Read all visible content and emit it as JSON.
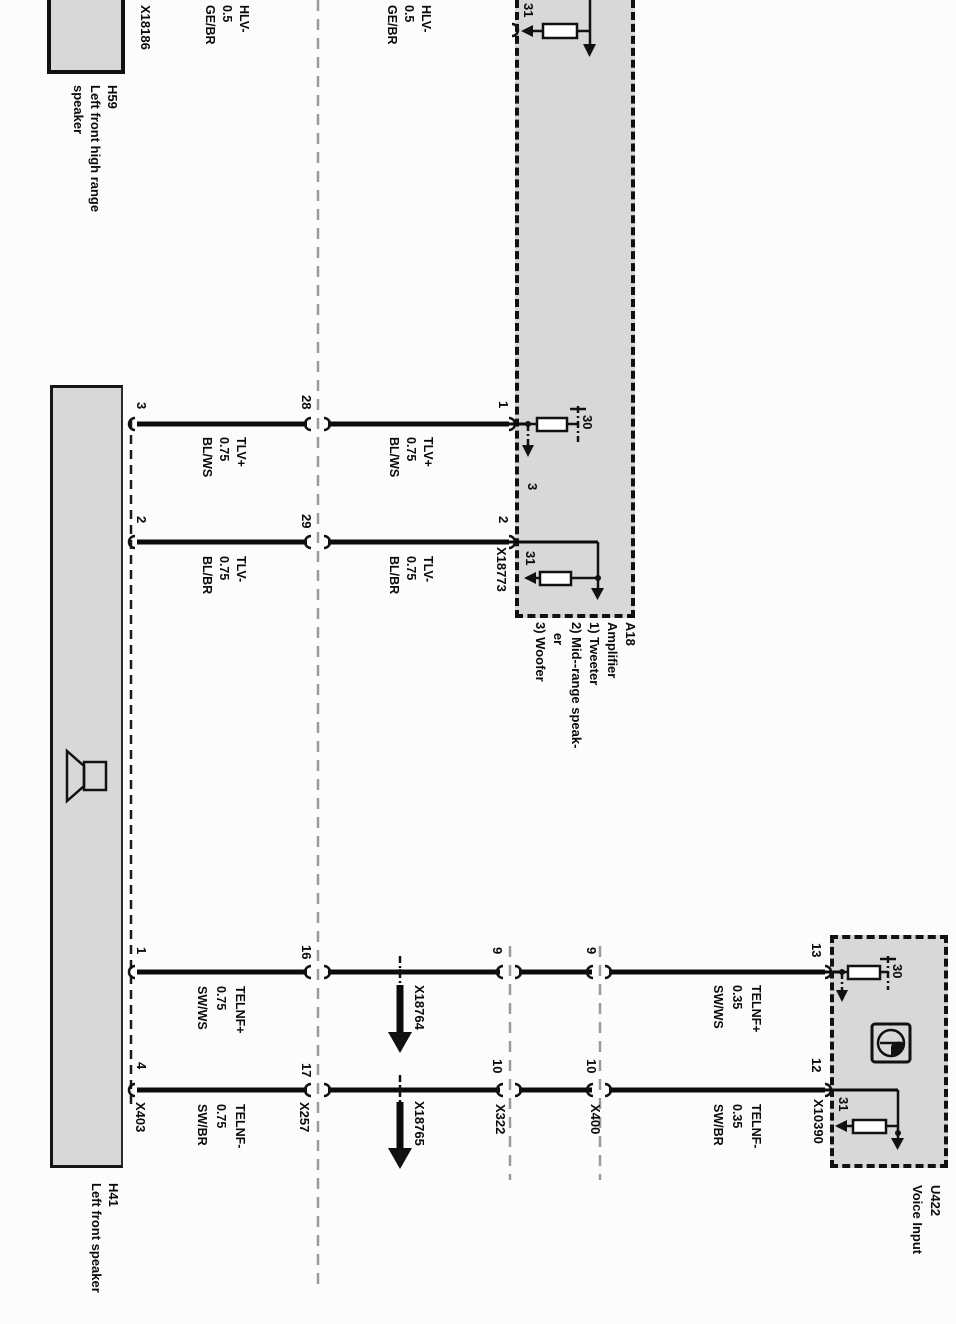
{
  "colors": {
    "box_fill": "#d8d8d8",
    "line": "#000000",
    "connector_line_gray": "#9a9a9a"
  },
  "components": {
    "h59": {
      "caption": "H59\nLeft front high range\nspeaker",
      "connector_label": "X18186"
    },
    "h41": {
      "caption": "H41\nLeft front speaker",
      "connector_label": "X403",
      "pins": {
        "tlv_plus": "3",
        "tlv_minus": "2",
        "telnf_plus": "1",
        "telnf_minus": "4"
      }
    },
    "a18": {
      "caption": "A18\nAmplifier\n1) Tweeter\n2) Mid--range speak-\n   er\n3) Woofer",
      "pins": {
        "tlv_plus": "1",
        "tlv_minus": "2"
      },
      "circuit_number": "3",
      "connector_label": "X18773",
      "terminal_30": "30",
      "terminal_31_top": "31",
      "terminal_31_bottom": "31"
    },
    "u422": {
      "caption": "U422\nVoice Input",
      "pins": {
        "telnf_plus": "13",
        "telnf_minus": "12"
      },
      "connector_label": "X10390",
      "terminal_30": "30",
      "terminal_31": "31"
    }
  },
  "connectors": {
    "x257": {
      "label": "X257",
      "pins_top": {
        "tlv_plus": "28",
        "tlv_minus": "29"
      },
      "pins_bottom": {
        "telnf_plus": "16",
        "telnf_minus": "17"
      }
    },
    "x322": {
      "label": "X322",
      "pins": {
        "telnf_plus": "9",
        "telnf_minus": "10"
      }
    },
    "x400": {
      "label": "X400",
      "pins": {
        "telnf_plus": "9",
        "telnf_minus": "10"
      }
    },
    "x18764": {
      "label": "X18764"
    },
    "x18765": {
      "label": "X18765"
    }
  },
  "wire_labels": {
    "hlv_1": "HLV-\n0.5\nGE/BR",
    "hlv_2": "HLV-\n0.5\nGE/BR",
    "tlv_plus_1": "TLV+\n0.75\nBL/WS",
    "tlv_minus_1": "TLV-\n0.75\nBL/BR",
    "tlv_plus_2": "TLV+\n0.75\nBL/WS",
    "tlv_minus_2": "TLV-\n0.75\nBL/BR",
    "telnf_plus_75": "TELNF+\n0.75\nSW/WS",
    "telnf_minus_75": "TELNF-\n0.75\nSW/BR",
    "telnf_plus_35": "TELNF+\n0.35\nSW/WS",
    "telnf_minus_35": "TELNF-\n0.35\nSW/BR"
  }
}
